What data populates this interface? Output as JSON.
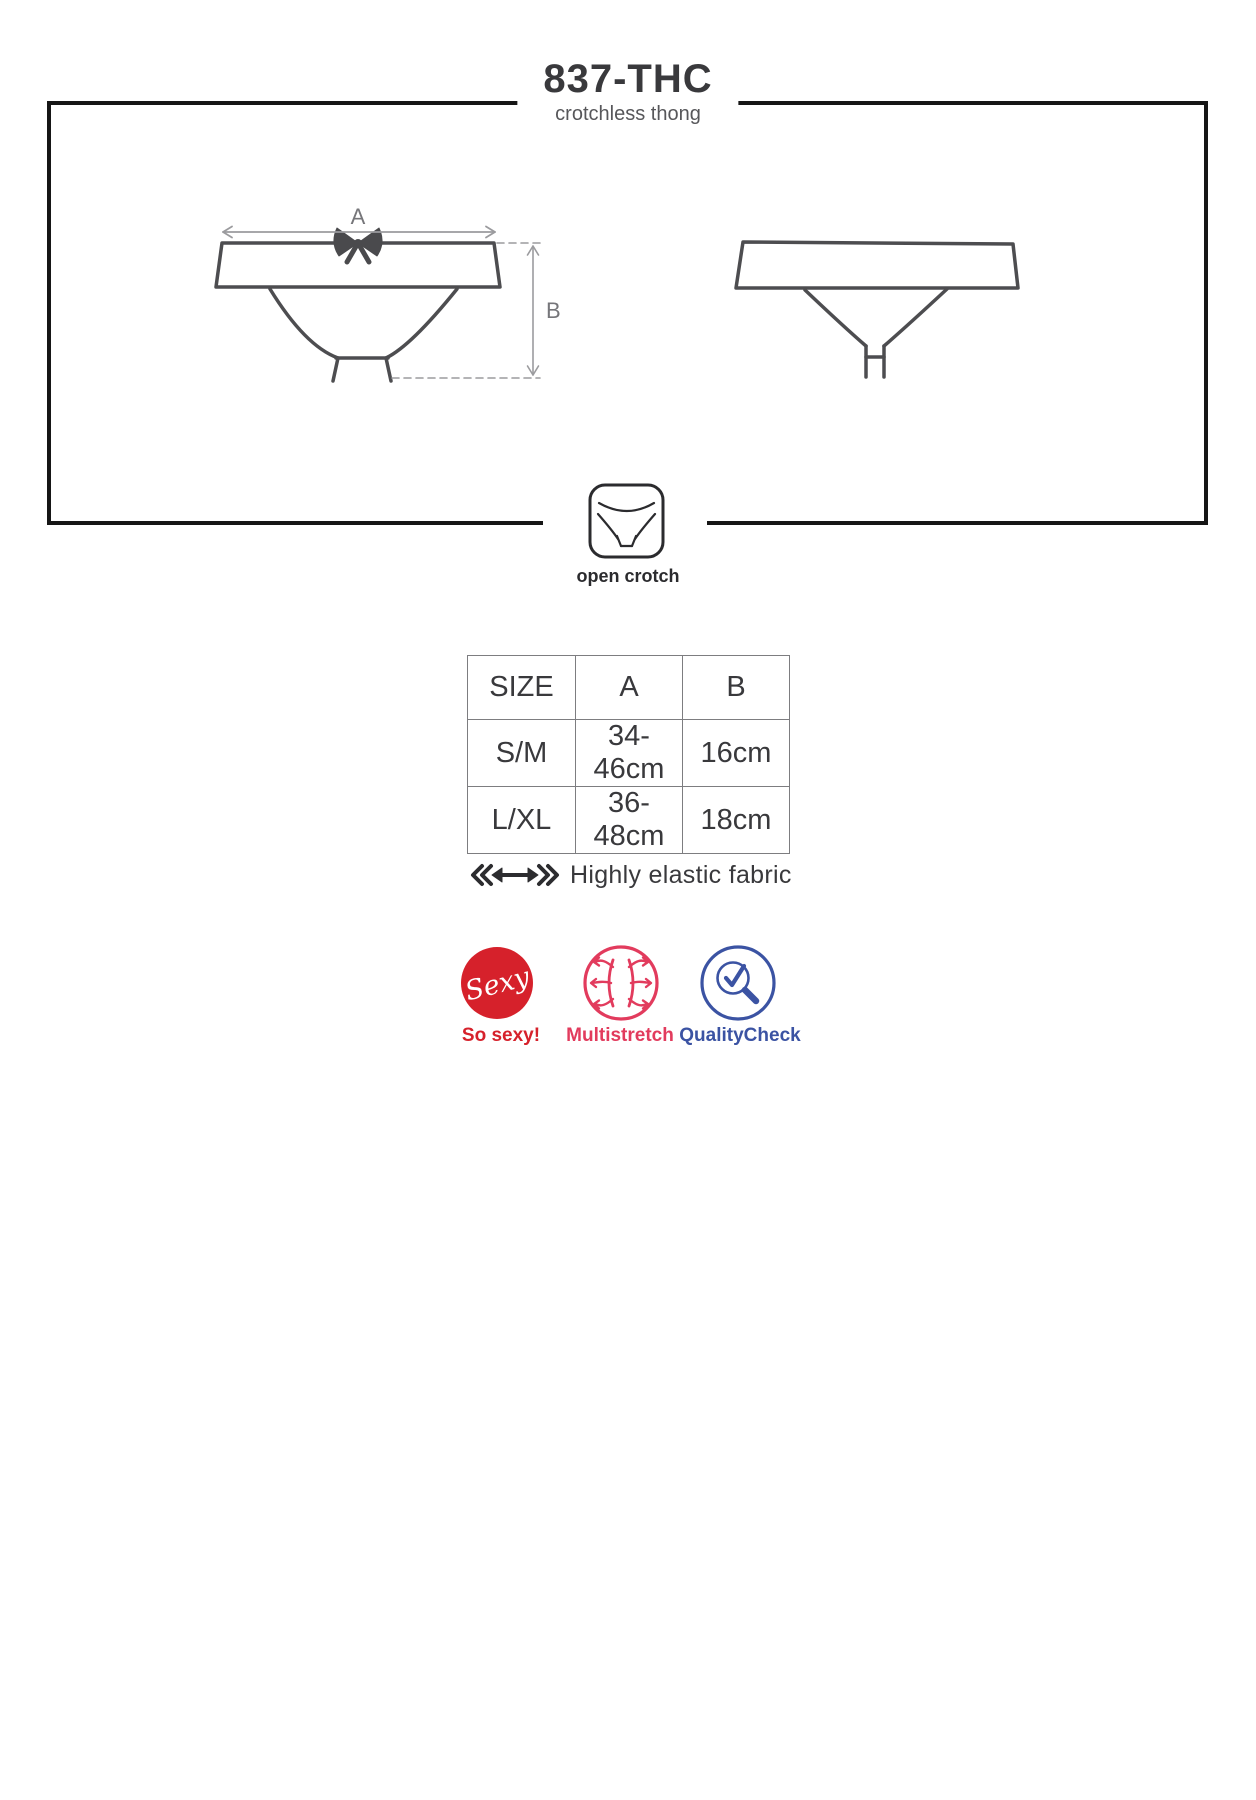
{
  "page": {
    "title": "837-THC",
    "subtitle": "crotchless thong"
  },
  "diagram": {
    "dim_a": "A",
    "dim_b": "B",
    "open_crotch": "open crotch",
    "views": [
      "front",
      "back"
    ],
    "line_color": "#4d4d50",
    "dimension_color": "#9b9b9e",
    "frame_color": "#161616"
  },
  "table": {
    "headers": [
      "SIZE",
      "A",
      "B"
    ],
    "rows": [
      [
        "S/M",
        "34-46cm",
        "16cm"
      ],
      [
        "L/XL",
        "36-48cm",
        "18cm"
      ]
    ]
  },
  "fabric": {
    "note": "Highly elastic fabric"
  },
  "badges": [
    {
      "circle_text": "Sexy",
      "label": "So sexy!",
      "color": "#d6212b"
    },
    {
      "label": "Multistretch",
      "color": "#e23b5d"
    },
    {
      "label": "QualityCheck",
      "color": "#3b53a3"
    }
  ]
}
